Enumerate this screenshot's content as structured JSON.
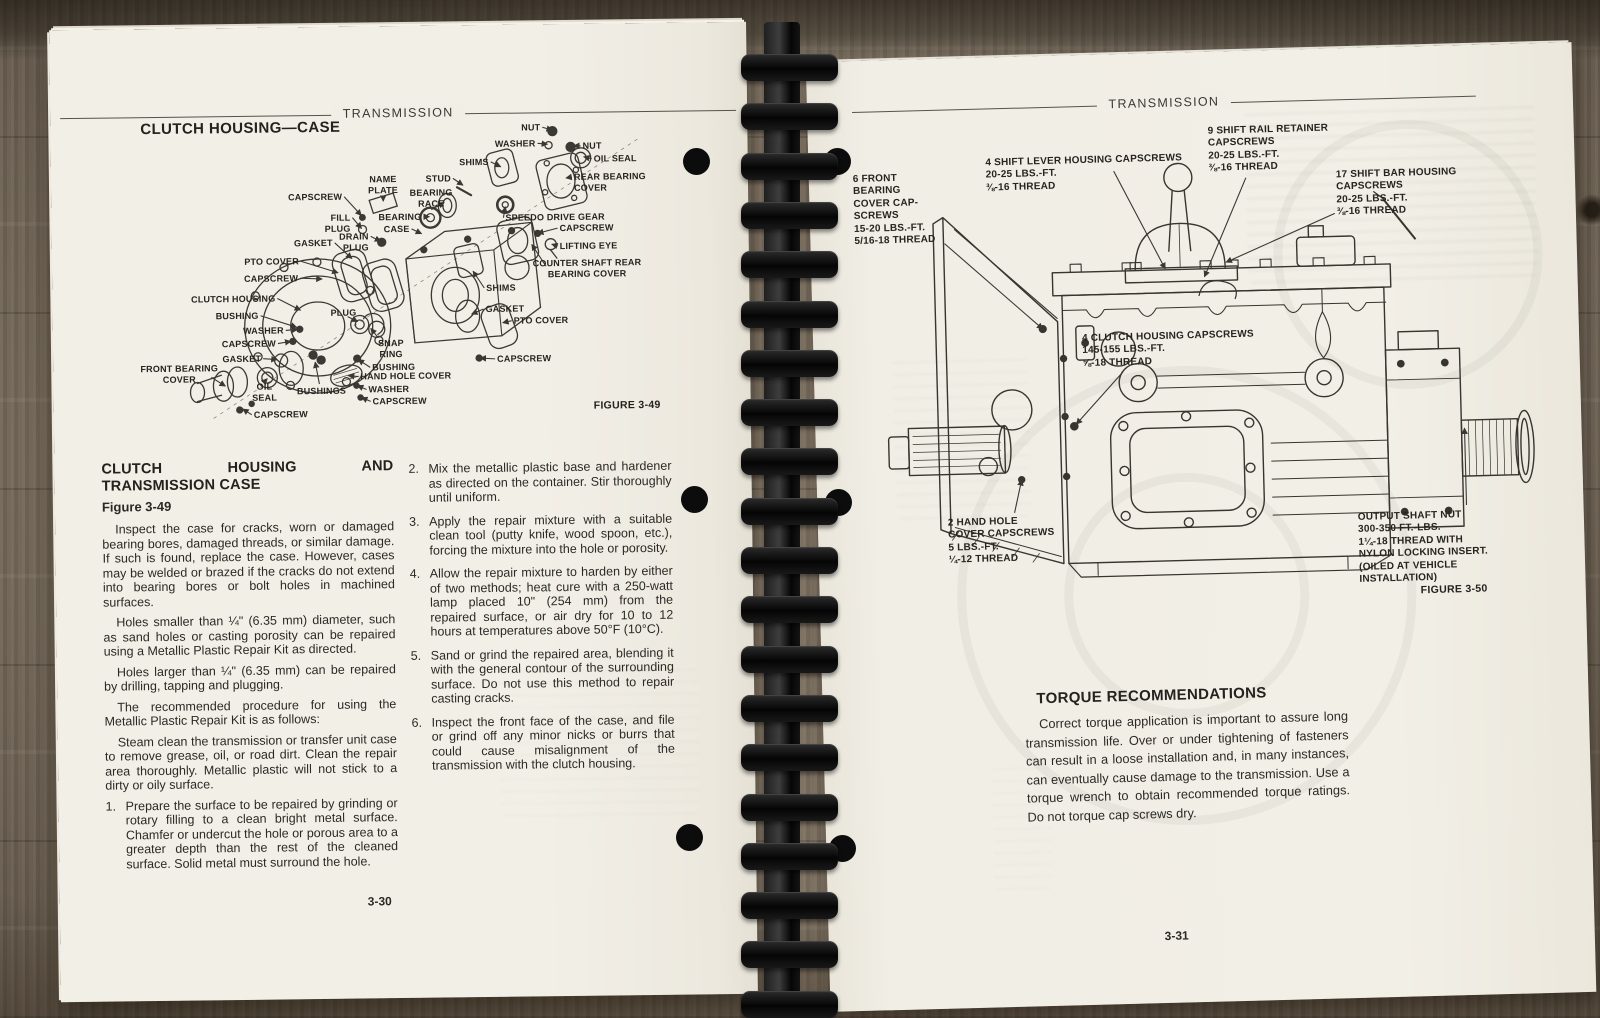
{
  "style": {
    "paper": "#f0ede5",
    "ink": "#2b2924",
    "wood": "#7c7060",
    "binding": "#0c0c0c"
  },
  "left_page": {
    "running_head": "TRANSMISSION",
    "section_title": "CLUTCH HOUSING—CASE",
    "figure_caption": "FIGURE 3-49",
    "page_number": "3-30",
    "heading_lines": [
      "CLUTCH HOUSING AND",
      "TRANSMISSION CASE"
    ],
    "figure_ref": "Figure 3-49",
    "col1_paras": [
      "Inspect the case for cracks, worn or damaged bearing bores, damaged threads, or similar damage. If such is found, replace the case. However, cases may be welded or brazed if the cracks do not extend into bearing bores or bolt holes in machined surfaces.",
      "Holes smaller than ¼\" (6.35 mm) diameter, such as sand holes or casting porosity can be repaired using a Metallic Plastic Repair Kit as directed.",
      "Holes larger than ¼\" (6.35 mm) can be repaired by drilling, tapping and plugging.",
      "The recommended procedure for using the Metallic Plastic Repair Kit is as follows:",
      "Steam clean the transmission or transfer unit case to remove grease, oil, or road dirt. Clean the repair area thoroughly. Metallic plastic will not stick to a dirty or oily surface."
    ],
    "col1_list": [
      {
        "n": "1.",
        "t": "Prepare the surface to be repaired by grinding or rotary filling to a clean bright metal surface. Chamfer or undercut the hole or porous area to a greater depth than the rest of the cleaned surface. Solid metal must surround the hole."
      }
    ],
    "col2_list": [
      {
        "n": "2.",
        "t": "Mix the metallic plastic base and hardener as directed on the container. Stir thoroughly until uniform."
      },
      {
        "n": "3.",
        "t": "Apply the repair mixture with a suitable clean tool (putty knife, wood spoon, etc.), forcing the mixture into the hole or porosity."
      },
      {
        "n": "4.",
        "t": "Allow the repair mixture to harden by either of two methods; heat cure with a 250-watt lamp placed 10\" (254 mm) from the repaired surface, or air dry for 10 to 12 hours at temperatures above 50°F (10°C)."
      },
      {
        "n": "5.",
        "t": "Sand or grind the repaired area, blending it with the general contour of the surrounding surface. Do not use this method to repair casting cracks."
      },
      {
        "n": "6.",
        "t": "Inspect the front face of the case, and file or grind off any minor nicks or burrs that could cause misalignment of the transmission with the clutch housing."
      }
    ],
    "diagram_labels": [
      {
        "t": "NUT",
        "x": 488,
        "y": 96,
        "a": "r",
        "tx": 500,
        "ty": 104
      },
      {
        "t": "WASHER",
        "x": 483,
        "y": 112,
        "a": "r",
        "tx": 495,
        "ty": 118
      },
      {
        "t": "NUT",
        "x": 530,
        "y": 115,
        "a": "l",
        "tx": 521,
        "ty": 120
      },
      {
        "t": "OIL SEAL",
        "x": 541,
        "y": 128,
        "a": "l",
        "tx": 531,
        "ty": 131
      },
      {
        "t": "SHIMS",
        "x": 436,
        "y": 130,
        "a": "r",
        "tx": 448,
        "ty": 140
      },
      {
        "t": "REAR BEARING\nCOVER",
        "x": 521,
        "y": 146,
        "a": "l",
        "tx": 513,
        "ty": 152
      },
      {
        "t": "STUD",
        "x": 398,
        "y": 146,
        "a": "r",
        "tx": 410,
        "ty": 158
      },
      {
        "t": "NAME\nPLATE",
        "x": 330,
        "y": 146,
        "a": "c",
        "tx": 330,
        "ty": 173
      },
      {
        "t": "CAPSCREW",
        "x": 289,
        "y": 163,
        "a": "r",
        "tx": 308,
        "ty": 187
      },
      {
        "t": "BEARING\nRACE",
        "x": 378,
        "y": 160,
        "a": "c",
        "tx": 391,
        "ty": 175
      },
      {
        "t": "BEARING",
        "x": 368,
        "y": 184,
        "a": "r",
        "tx": 376,
        "ty": 189
      },
      {
        "t": "SPEEDO DRIVE GEAR",
        "x": 452,
        "y": 186,
        "a": "l",
        "tx": 452,
        "ty": 180
      },
      {
        "t": "FILL\nPLUG",
        "x": 297,
        "y": 184,
        "a": "r",
        "tx": 308,
        "ty": 200
      },
      {
        "t": "CASE",
        "x": 356,
        "y": 196,
        "a": "r",
        "tx": 368,
        "ty": 206
      },
      {
        "t": "CAPSCREW",
        "x": 506,
        "y": 197,
        "a": "l",
        "tx": 484,
        "ty": 207
      },
      {
        "t": "DRAIN\nPLUG",
        "x": 315,
        "y": 203,
        "a": "r",
        "tx": 327,
        "ty": 213
      },
      {
        "t": "LIFTING EYE",
        "x": 506,
        "y": 215,
        "a": "l",
        "tx": 498,
        "ty": 218
      },
      {
        "t": "GASKET",
        "x": 279,
        "y": 209,
        "a": "r",
        "tx": 298,
        "ty": 230
      },
      {
        "t": "PTO COVER",
        "x": 245,
        "y": 227,
        "a": "r",
        "tx": 284,
        "ty": 244
      },
      {
        "t": "COUNTER SHAFT REAR\nBEARING COVER",
        "x": 533,
        "y": 232,
        "a": "c",
        "sx": 492,
        "sy": 240,
        "tx": 478,
        "ty": 218
      },
      {
        "t": "CAPSCREW",
        "x": 244,
        "y": 244,
        "a": "r",
        "tx": 268,
        "ty": 250
      },
      {
        "t": "SHIMS",
        "x": 432,
        "y": 256,
        "a": "l",
        "tx": 419,
        "ty": 244
      },
      {
        "t": "CLUTCH HOUSING",
        "x": 221,
        "y": 264,
        "a": "r",
        "tx": 246,
        "ty": 281
      },
      {
        "t": "GASKET",
        "x": 431,
        "y": 277,
        "a": "l",
        "tx": 417,
        "ty": 287
      },
      {
        "t": "BUSHING",
        "x": 204,
        "y": 281,
        "a": "r",
        "tx": 242,
        "ty": 298
      },
      {
        "t": "PTO COVER",
        "x": 459,
        "y": 289,
        "a": "l",
        "tx": 448,
        "ty": 296
      },
      {
        "t": "PLUG",
        "x": 276,
        "y": 279,
        "a": "l",
        "sx": 293,
        "sy": 288,
        "tx": 303,
        "ty": 293
      },
      {
        "t": "WASHER",
        "x": 229,
        "y": 296,
        "a": "r",
        "tx": 243,
        "ty": 300
      },
      {
        "t": "CAPSCREW",
        "x": 221,
        "y": 309,
        "a": "r",
        "tx": 236,
        "ty": 312
      },
      {
        "t": "SNAP\nRING",
        "x": 336,
        "y": 310,
        "a": "c",
        "sx": 323,
        "sy": 309,
        "tx": 316,
        "ty": 300
      },
      {
        "t": "GASKET",
        "x": 206,
        "y": 324,
        "a": "r",
        "tx": 222,
        "ty": 330
      },
      {
        "t": "CAPSCREW",
        "x": 442,
        "y": 327,
        "a": "l",
        "tx": 425,
        "ty": 331
      },
      {
        "t": "FRONT BEARING\nCOVER",
        "x": 124,
        "y": 333,
        "a": "c",
        "sx": 156,
        "sy": 347,
        "tx": 170,
        "ty": 356
      },
      {
        "t": "BUSHING",
        "x": 317,
        "y": 334,
        "a": "l",
        "tx": 303,
        "ty": 331
      },
      {
        "t": "HAND HOLE COVER",
        "x": 305,
        "y": 343,
        "a": "l",
        "tx": 293,
        "ty": 347
      },
      {
        "t": "OIL\nSEAL",
        "x": 209,
        "y": 352,
        "a": "c",
        "sx": 210,
        "sy": 351,
        "tx": 212,
        "ty": 349
      },
      {
        "t": "BUSHINGS",
        "x": 266,
        "y": 357,
        "a": "c",
        "sx": 264,
        "sy": 355,
        "tx": 260,
        "ty": 333
      },
      {
        "t": "WASHER",
        "x": 313,
        "y": 356,
        "a": "l",
        "tx": 302,
        "ty": 357
      },
      {
        "t": "CAPSCREW",
        "x": 317,
        "y": 368,
        "a": "l",
        "tx": 306,
        "ty": 369
      },
      {
        "t": "CAPSCREW",
        "x": 198,
        "y": 380,
        "a": "l",
        "tx": 187,
        "ty": 379
      }
    ]
  },
  "right_page": {
    "running_head": "TRANSMISSION",
    "figure_caption": "FIGURE 3-50",
    "page_number": "3-31",
    "torque_heading": "TORQUE RECOMMENDATIONS",
    "torque_para": "Correct torque application is important to assure long transmission life. Over or under tightening of fasteners can result in a loose installation and, in many instances, can eventually cause damage to the transmission. Use a torque wrench to obtain recommended torque ratings. Do not torque cap screws dry.",
    "callouts": [
      {
        "t": "6 FRONT\nBEARING\nCOVER CAP-\nSCREWS\n15-20 LBS.-FT.\n5/16-18 THREAD",
        "x": 7,
        "y": 110,
        "a": "l",
        "sx": 97,
        "sy": 182,
        "tx": 193,
        "ty": 270
      },
      {
        "t": "4 SHIFT LEVER HOUSING CAPSCREWS\n20-25 LBS.-FT.\n⅜-16 THREAD",
        "x": 140,
        "y": 97,
        "a": "l",
        "sx": 268,
        "sy": 114,
        "tx": 317,
        "ty": 213
      },
      {
        "t": "9 SHIFT RAIL RETAINER\nCAPSCREWS\n20-25 LBS.-FT.\n⅜-16 THREAD",
        "x": 363,
        "y": 71,
        "a": "l",
        "sx": 400,
        "sy": 124,
        "tx": 356,
        "ty": 222
      },
      {
        "t": "17 SHIFT BAR HOUSING\nCAPSCREWS\n20-25 LBS.-FT.\n⅜-16 THREAD",
        "x": 490,
        "y": 118,
        "a": "l",
        "sx": 488,
        "sy": 162,
        "tx": 378,
        "ty": 208
      },
      {
        "t": "4 CLUTCH HOUSING CAPSCREWS\n145-155 LBS.-FT.\n⅝-18 THREAD",
        "x": 232,
        "y": 275,
        "a": "l",
        "sx": 272,
        "sy": 315,
        "tx": 224,
        "ty": 366
      },
      {
        "t": "2 HAND HOLE\nCOVER CAPSCREWS\n5 LBS.-FT.\n¼-12 THREAD",
        "x": 93,
        "y": 456,
        "a": "l",
        "sx": 160,
        "sy": 453,
        "tx": 168,
        "ty": 420
      },
      {
        "t": "OUTPUT SHAFT NUT\n300-350 FT.-LBS.\n1¼-18 THREAD WITH\nNYLON LOCKING INSERT.\n(OILED AT VEHICLE\nINSTALLATION)",
        "x": 503,
        "y": 461,
        "a": "l",
        "sx": 612,
        "sy": 457,
        "tx": 612,
        "ty": 380
      }
    ]
  }
}
